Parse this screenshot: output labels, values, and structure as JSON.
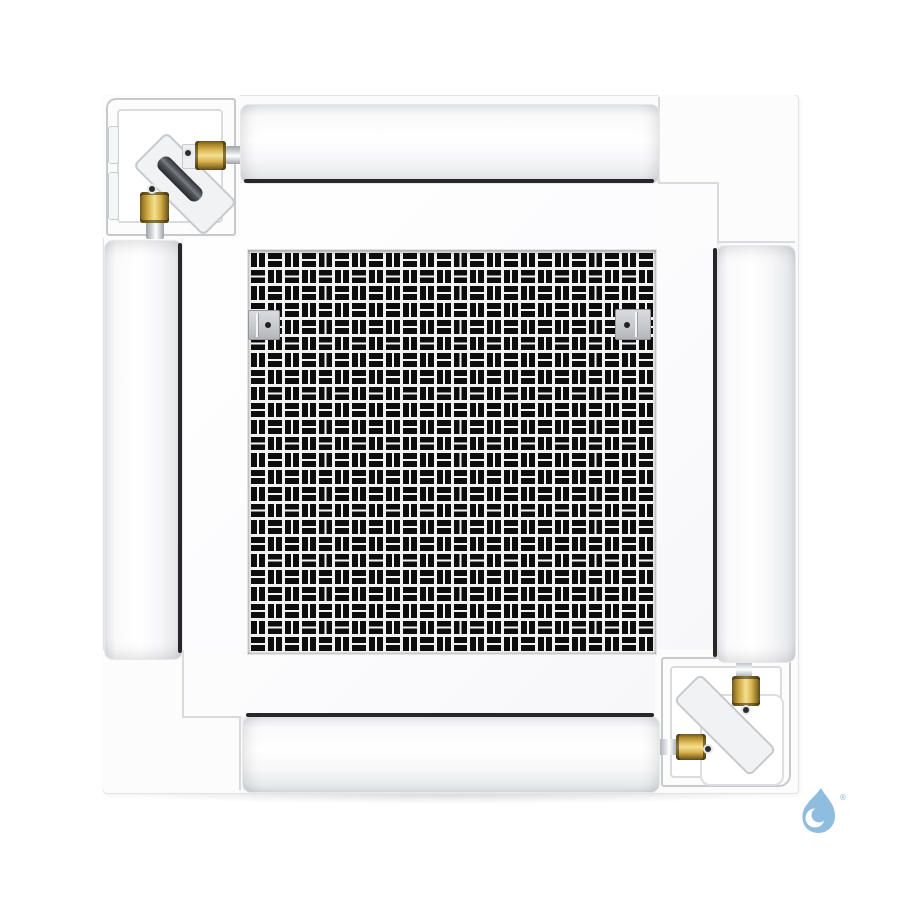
{
  "meta": {
    "type": "product-photo",
    "subject": "4-way ceiling cassette air conditioner indoor unit, bottom view"
  },
  "unit": {
    "panel_color": "#fbfbfc",
    "flap_count": 4,
    "latch_count": 2,
    "grille": {
      "rows": 24,
      "cols": 24,
      "slot_color": "#0d0d0e",
      "line_color": "#f2f2f3",
      "pattern": "basketweave-checkerboard"
    }
  },
  "pipes": {
    "corner_positions": [
      "top-left",
      "bottom-right"
    ],
    "brass_color": "#d9b44e",
    "dark_pipe_color": "#3c4045",
    "silver_color": "#c9cbce"
  },
  "watermark": {
    "symbol": "water-drop",
    "color": "#8ebde0",
    "registered_mark": "®"
  }
}
